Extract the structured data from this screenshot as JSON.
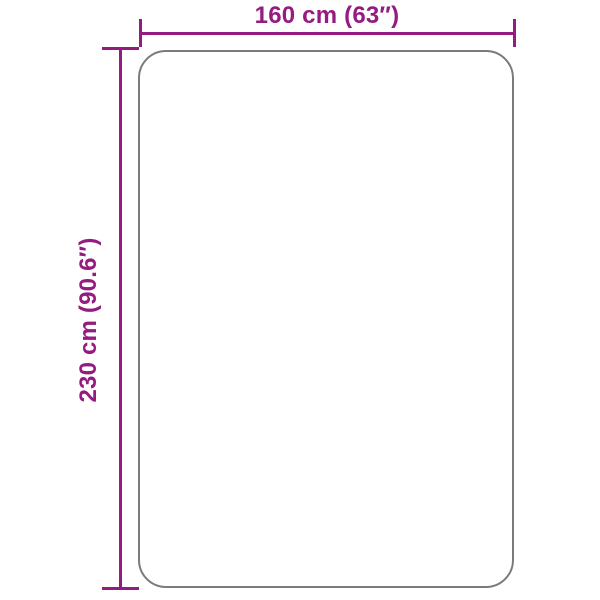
{
  "diagram": {
    "type": "product-dimension-diagram",
    "product": "rug-outline-rectangle-rounded",
    "width_label": "160 cm (63″)",
    "height_label": "230 cm (90.6″)",
    "width_value_cm": 160,
    "width_value_in": 63,
    "height_value_cm": 230,
    "height_value_in": 90.6,
    "accent_color": "#951b81",
    "outline_color": "#7b7b7b",
    "background_color": "#ffffff"
  }
}
